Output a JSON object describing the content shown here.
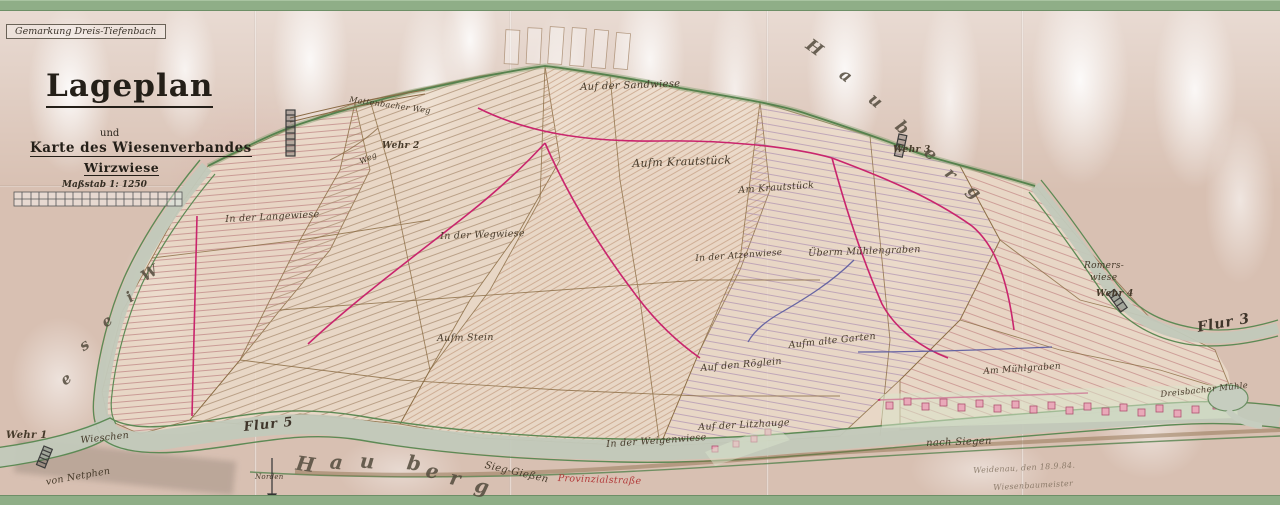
{
  "sheet": {
    "gemarkung": "Gemarkung Dreis-Tiefenbach"
  },
  "title_block": {
    "title": "Lageplan",
    "connector": "und",
    "line2": "Karte des Wiesenverbandes",
    "line3": "Wirzwiese",
    "scale_label": "Maßstab 1: 1250"
  },
  "field_labels": {
    "sandwiese": "Auf der Sandwiese",
    "aufm_krautstueck": "Aufm Krautstück",
    "am_krautstueck": "Am Krautstück",
    "langewiese": "In der Langewiese",
    "wegwiese": "In der Wegwiese",
    "aufm_stein": "Aufm Stein",
    "atzenwiese": "In der Atzenwiese",
    "ueberm_muehlengraben": "Überm Mühlengraben",
    "roeglein": "Auf den Röglein",
    "alte_garten": "Aufm alte Garten",
    "am_muehlgraben": "Am Mühlgraben",
    "weigenwiese": "In der Weigenwiese",
    "litzhauge": "Auf der Litzhauge",
    "romers_line1": "Romers-",
    "romers_line2": "wiese",
    "muehle": "Dreisbacher Mühle",
    "wieschen": "Wieschen"
  },
  "weirs": {
    "w1": "Wehr 1",
    "w2": "Wehr 2",
    "w3": "Wehr 3",
    "w4": "Wehr 4"
  },
  "flur": {
    "f3": "Flur 3",
    "f5": "Flur 5"
  },
  "directions": {
    "nach_siegen": "nach Siegen",
    "von_netphen": "von Netphen",
    "norden": "Norden"
  },
  "routes": {
    "sieg_giessen": "Sieg-Gießen",
    "provinzialstrasse": "Provinzialstraße",
    "mattenbacher_weg": "Mattenbacher Weg",
    "weg": "Weg"
  },
  "signature": {
    "line1": "Weidenau, den 18.9.84.",
    "line2": "Wiesenbaumeister"
  },
  "big_letters": {
    "hauberg_top": [
      "H",
      "a",
      "u",
      "b",
      "e",
      "r",
      "g"
    ],
    "hauberg_bottom": [
      "H",
      "a",
      "u",
      "b",
      "e",
      "r",
      "g"
    ],
    "wiese_left": [
      "W",
      "i",
      "e",
      "s",
      "e"
    ]
  },
  "colors": {
    "paper": "#d8c0b2",
    "tape_green": "#8fae87",
    "boundary_green": "#55824d",
    "river": "#c2c9ba",
    "ditch_magenta": "#c9256d",
    "ditch_blue": "#5a5aa0",
    "parcel_red": "#bb7f7f",
    "parcel_brown": "#a5876a",
    "building_pink": "#e9a9b9",
    "ink": "#463a2a"
  }
}
